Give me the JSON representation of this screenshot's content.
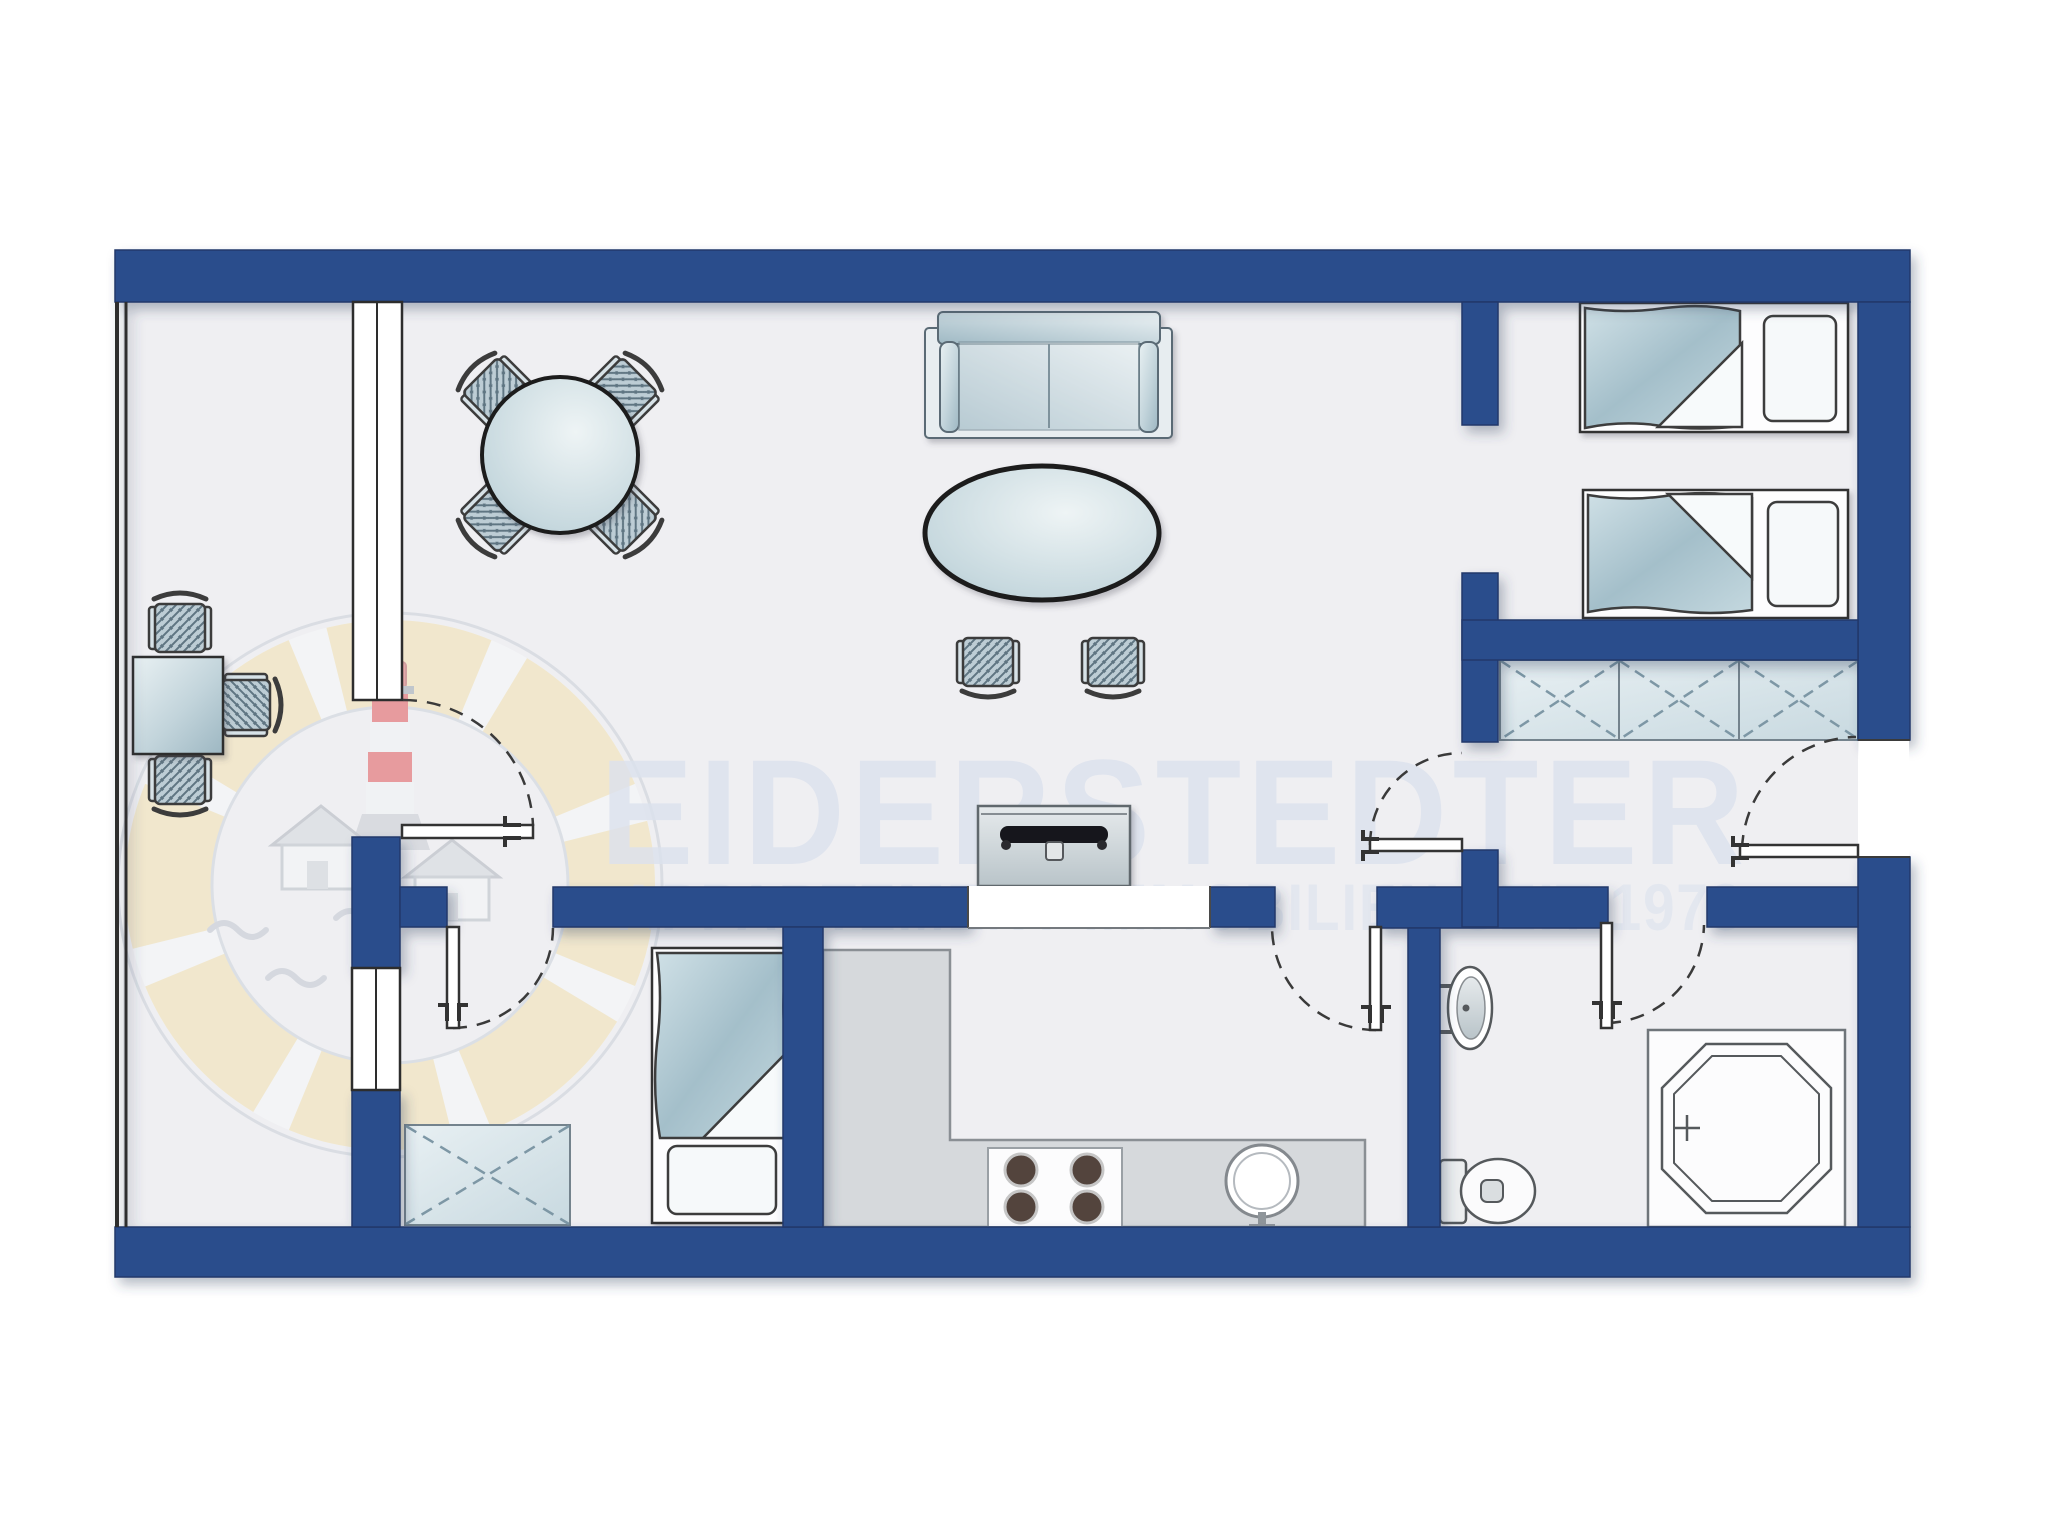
{
  "watermark": {
    "title": "EIDERSTEDTER",
    "subtitle": "APPARTEMENT  IMMOBILIEN  SEIT 1978"
  },
  "logo": {
    "name": "eiderstedter-lifering-lighthouse-logo",
    "parts": [
      "life-ring",
      "lighthouse",
      "house",
      "house",
      "waves"
    ],
    "ring_color": "#f3e2b0",
    "lighthouse_red": "#dd6f6f"
  },
  "palette": {
    "wall_blue": "#2b4d8c",
    "floor": "#efeff2",
    "outside": "#ffffff",
    "counter_gray": "#d6d9dc",
    "furniture_blue_gray": "#b9cbd4",
    "watermark_text": "#dce2ee",
    "outline": "#3a3a3a"
  },
  "plan": {
    "type": "apartment-floorplan-top-view",
    "rooms": [
      {
        "name": "living-dining-room",
        "items": [
          {
            "name": "sofa"
          },
          {
            "name": "oval-coffee-table"
          },
          {
            "name": "stool",
            "count": 2
          },
          {
            "name": "round-dining-table"
          },
          {
            "name": "dining-chair",
            "count": 4
          },
          {
            "name": "desk"
          },
          {
            "name": "desk-chair",
            "count": 3
          },
          {
            "name": "tv-sideboard"
          }
        ]
      },
      {
        "name": "twin-bedroom",
        "items": [
          {
            "name": "single-bed",
            "count": 2
          }
        ]
      },
      {
        "name": "hallway",
        "items": [
          {
            "name": "built-in-wardrobe",
            "sections": 3
          },
          {
            "name": "entry-door"
          }
        ]
      },
      {
        "name": "single-bedroom",
        "items": [
          {
            "name": "single-bed"
          },
          {
            "name": "wardrobe"
          }
        ]
      },
      {
        "name": "kitchen",
        "items": [
          {
            "name": "l-shaped-counter"
          },
          {
            "name": "cooktop",
            "burners": 4
          },
          {
            "name": "round-sink"
          }
        ]
      },
      {
        "name": "bathroom",
        "items": [
          {
            "name": "washbasin"
          },
          {
            "name": "toilet"
          },
          {
            "name": "octagonal-shower"
          }
        ]
      }
    ],
    "door_count": 6,
    "window_count": 2
  }
}
